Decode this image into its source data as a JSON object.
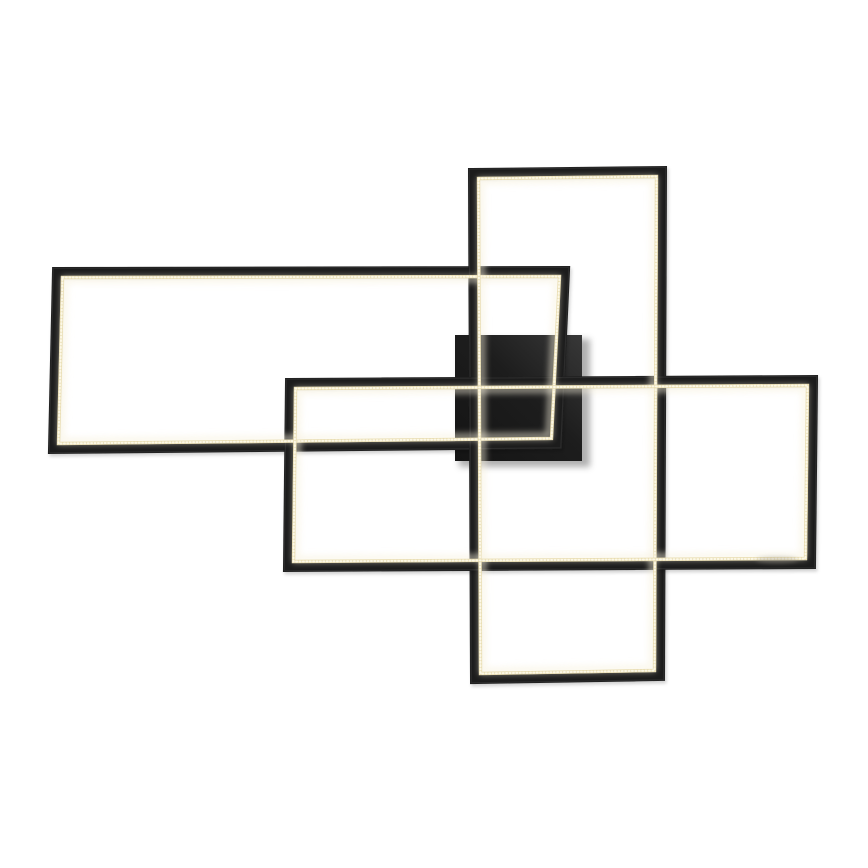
{
  "page": {
    "background_color": "#ffffff",
    "width": 868,
    "height": 868
  },
  "fixture": {
    "frame_color": "#1f1f1f",
    "frame_highlight_color": "#3a3a3a",
    "frame_thickness": 9,
    "led_core_color": "#e9ddb2",
    "led_dot_color": "#fffdf0",
    "led_halo_color": "#f7f1dd",
    "led_inset": 10.5,
    "canopy": {
      "x": 455,
      "y": 335,
      "width": 127,
      "height": 126,
      "color_dark": "#141414",
      "color_mid": "#1d1d1d",
      "color_sheen": "#383838",
      "shadow_color": "#6f6f6f"
    },
    "frames": [
      {
        "name": "left-horizontal-frame",
        "outer": [
          [
            52,
            267
          ],
          [
            570,
            266
          ],
          [
            562,
            449
          ],
          [
            48,
            454
          ]
        ]
      },
      {
        "name": "tall-vertical-frame",
        "outer": [
          [
            468,
            168
          ],
          [
            667,
            166
          ],
          [
            665,
            681
          ],
          [
            470,
            684
          ]
        ]
      },
      {
        "name": "large-horizontal-frame",
        "outer": [
          [
            285,
            378
          ],
          [
            818,
            375
          ],
          [
            816,
            569
          ],
          [
            283,
            572
          ]
        ]
      }
    ],
    "smudge": {
      "cx": 777,
      "cy": 560,
      "rx": 21,
      "ry": 3.5,
      "color": "#9a948a",
      "opacity": 0.38
    }
  }
}
